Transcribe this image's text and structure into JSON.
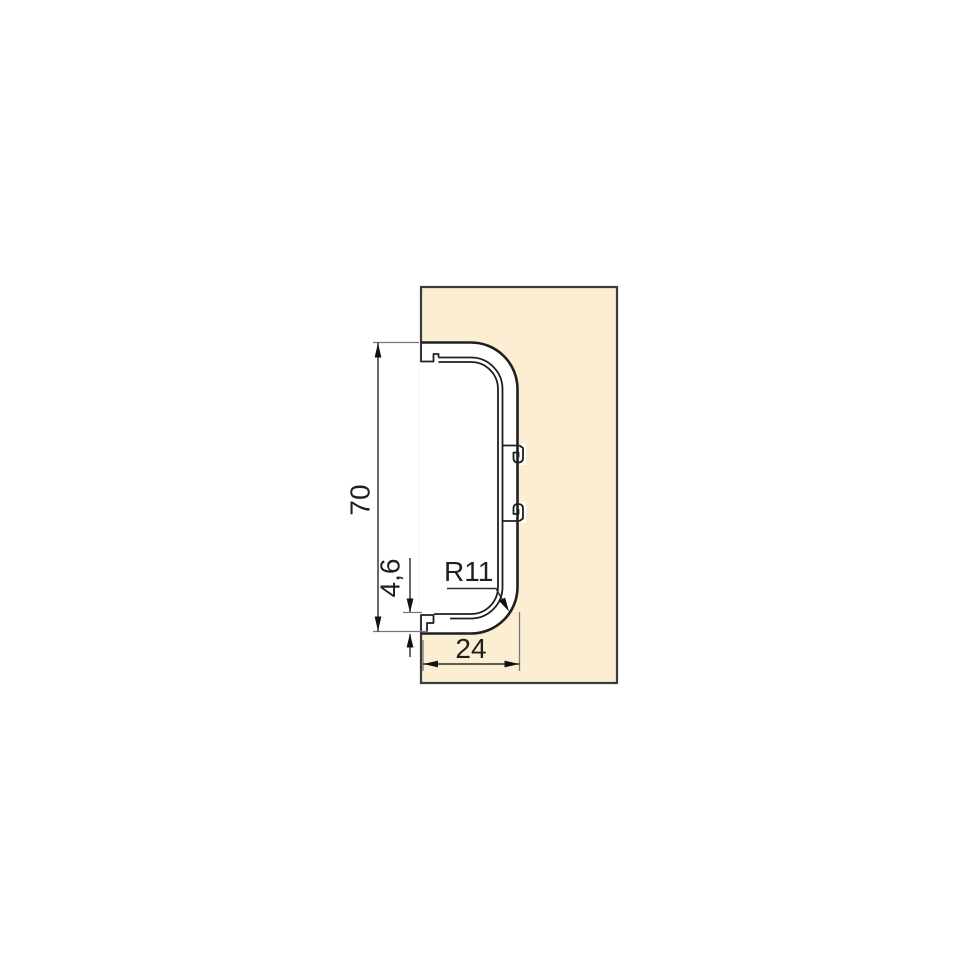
{
  "diagram": {
    "type": "technical-drawing",
    "subject": "gola-profile-cross-section-on-panel",
    "dimensions": [
      {
        "id": "overall-height",
        "label": "70",
        "orientation": "vertical"
      },
      {
        "id": "wall-thickness",
        "label": "4,6",
        "orientation": "vertical"
      },
      {
        "id": "corner-radius",
        "label": "R11",
        "orientation": "leader"
      },
      {
        "id": "profile-depth",
        "label": "24",
        "orientation": "horizontal"
      }
    ],
    "colors": {
      "panel_fill": "#FBEED3",
      "panel_border": "#3A3A3A",
      "profile_line": "#1F1F1F",
      "dimension_line": "#2B2B2B",
      "extension_line": "#777777",
      "background": "#FFFFFF"
    }
  }
}
